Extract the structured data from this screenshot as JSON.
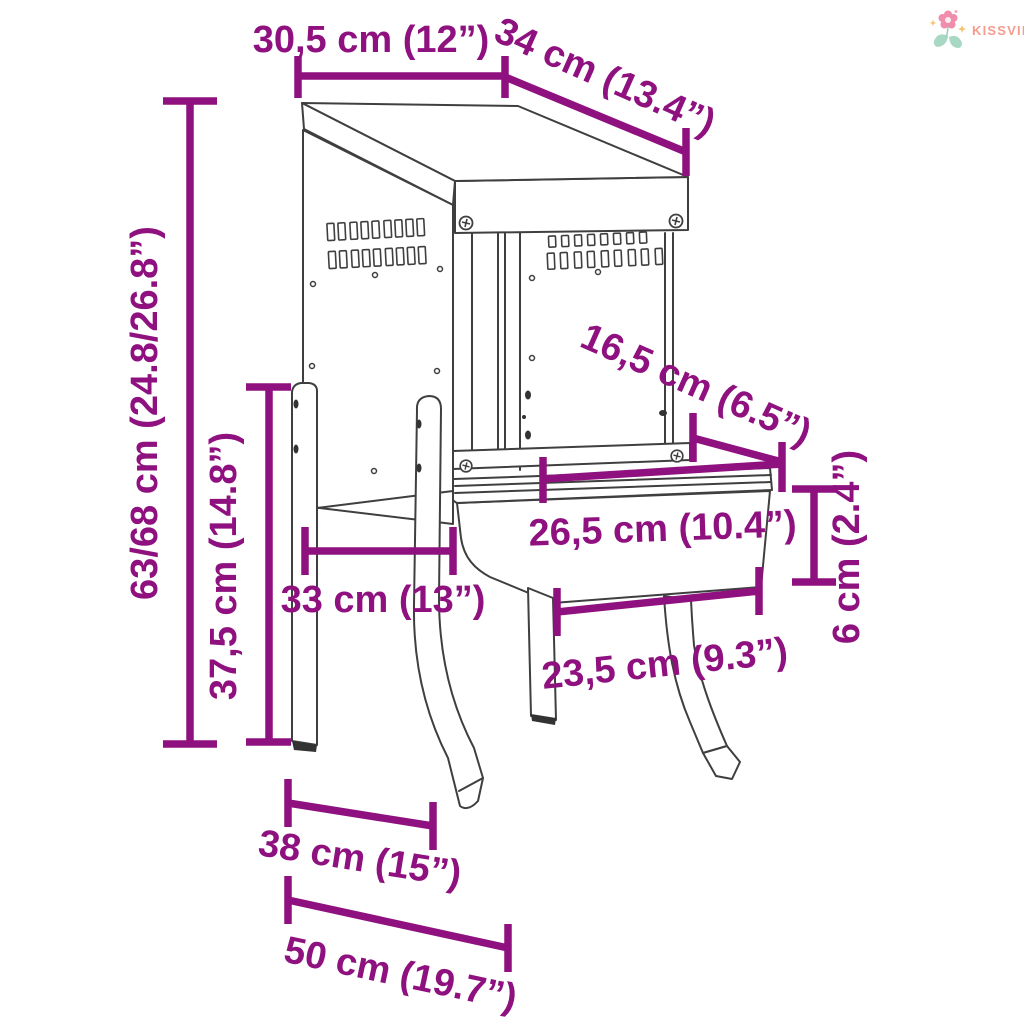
{
  "brand": {
    "name": "KISSVILÁG",
    "text_color": "#F59B8E",
    "flower_pink": "#F08CAC",
    "leaf_green": "#A8D8C4",
    "sparkle_yellow": "#F6C36B"
  },
  "diagram": {
    "accent_color": "#8F117F",
    "drawing_color": "#3F3F3F",
    "background_color": "#FFFFFF",
    "dimensions": {
      "top_width": "30,5 cm (12”)",
      "top_depth": "34 cm (13.4”)",
      "total_height": "63/68 cm (24.8/26.8”)",
      "leg_height": "37,5 cm (14.8”)",
      "leg_spacing_depth": "33 cm (13”)",
      "tray_opening_depth": "16,5 cm (6.5”)",
      "tray_top_width": "26,5 cm (10.4”)",
      "tray_height": "6 cm (2.4”)",
      "tray_bottom_width": "23,5 cm (9.3”)",
      "foot_depth": "38 cm (15”)",
      "foot_width": "50 cm (19.7”)"
    }
  }
}
